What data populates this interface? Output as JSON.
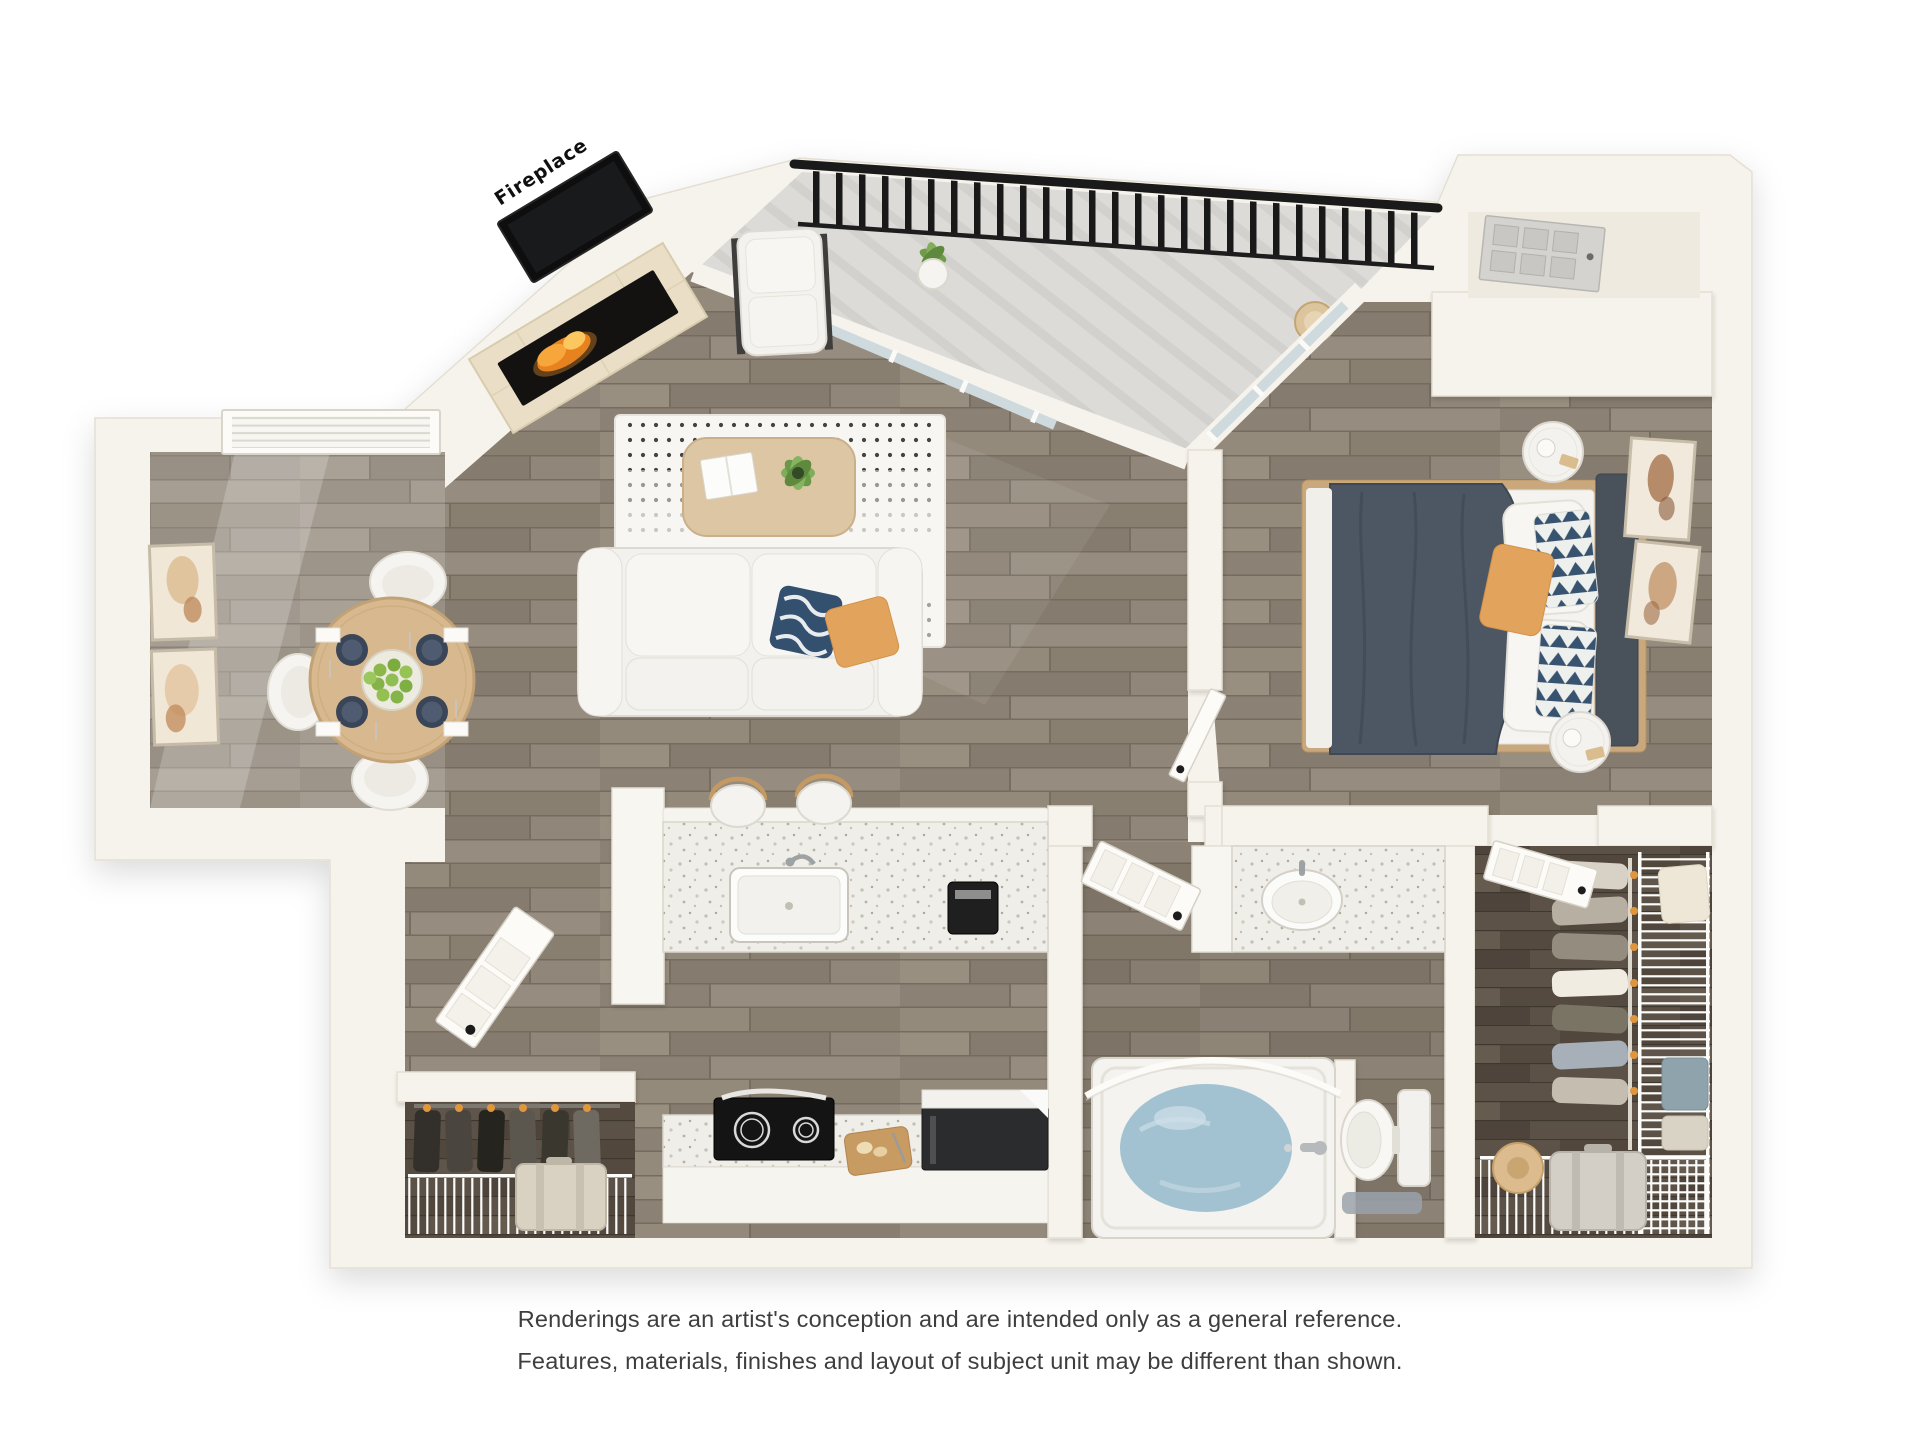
{
  "floorplan": {
    "labels": {
      "fireplace": "Fireplace"
    }
  },
  "disclaimer": {
    "line1": "Renderings are an artist's conception and are intended only as a general reference.",
    "line2": "Features, materials, finishes and layout of subject unit may be different than shown."
  },
  "colors": {
    "page-bg": "#ffffff",
    "wall": "#f6f3ec",
    "wall-edge": "#e4dfd3",
    "wood": "#8e8376",
    "wood-dark": "#574c41",
    "concrete": "#dcdbd7",
    "counter": "#efede6",
    "railing": "#1a1a1a",
    "water": "#a3c2d1",
    "duvet": "#4d5663",
    "headboard": "#49515b",
    "accent-orange": "#e2a45c",
    "navy": "#33506e",
    "fire": "#f59b2d",
    "table-wood": "#d8b98f",
    "hanger": "#e0963c",
    "glass": "#cfdade",
    "label": "#0f0f0f",
    "text": "#3e3e3e"
  }
}
